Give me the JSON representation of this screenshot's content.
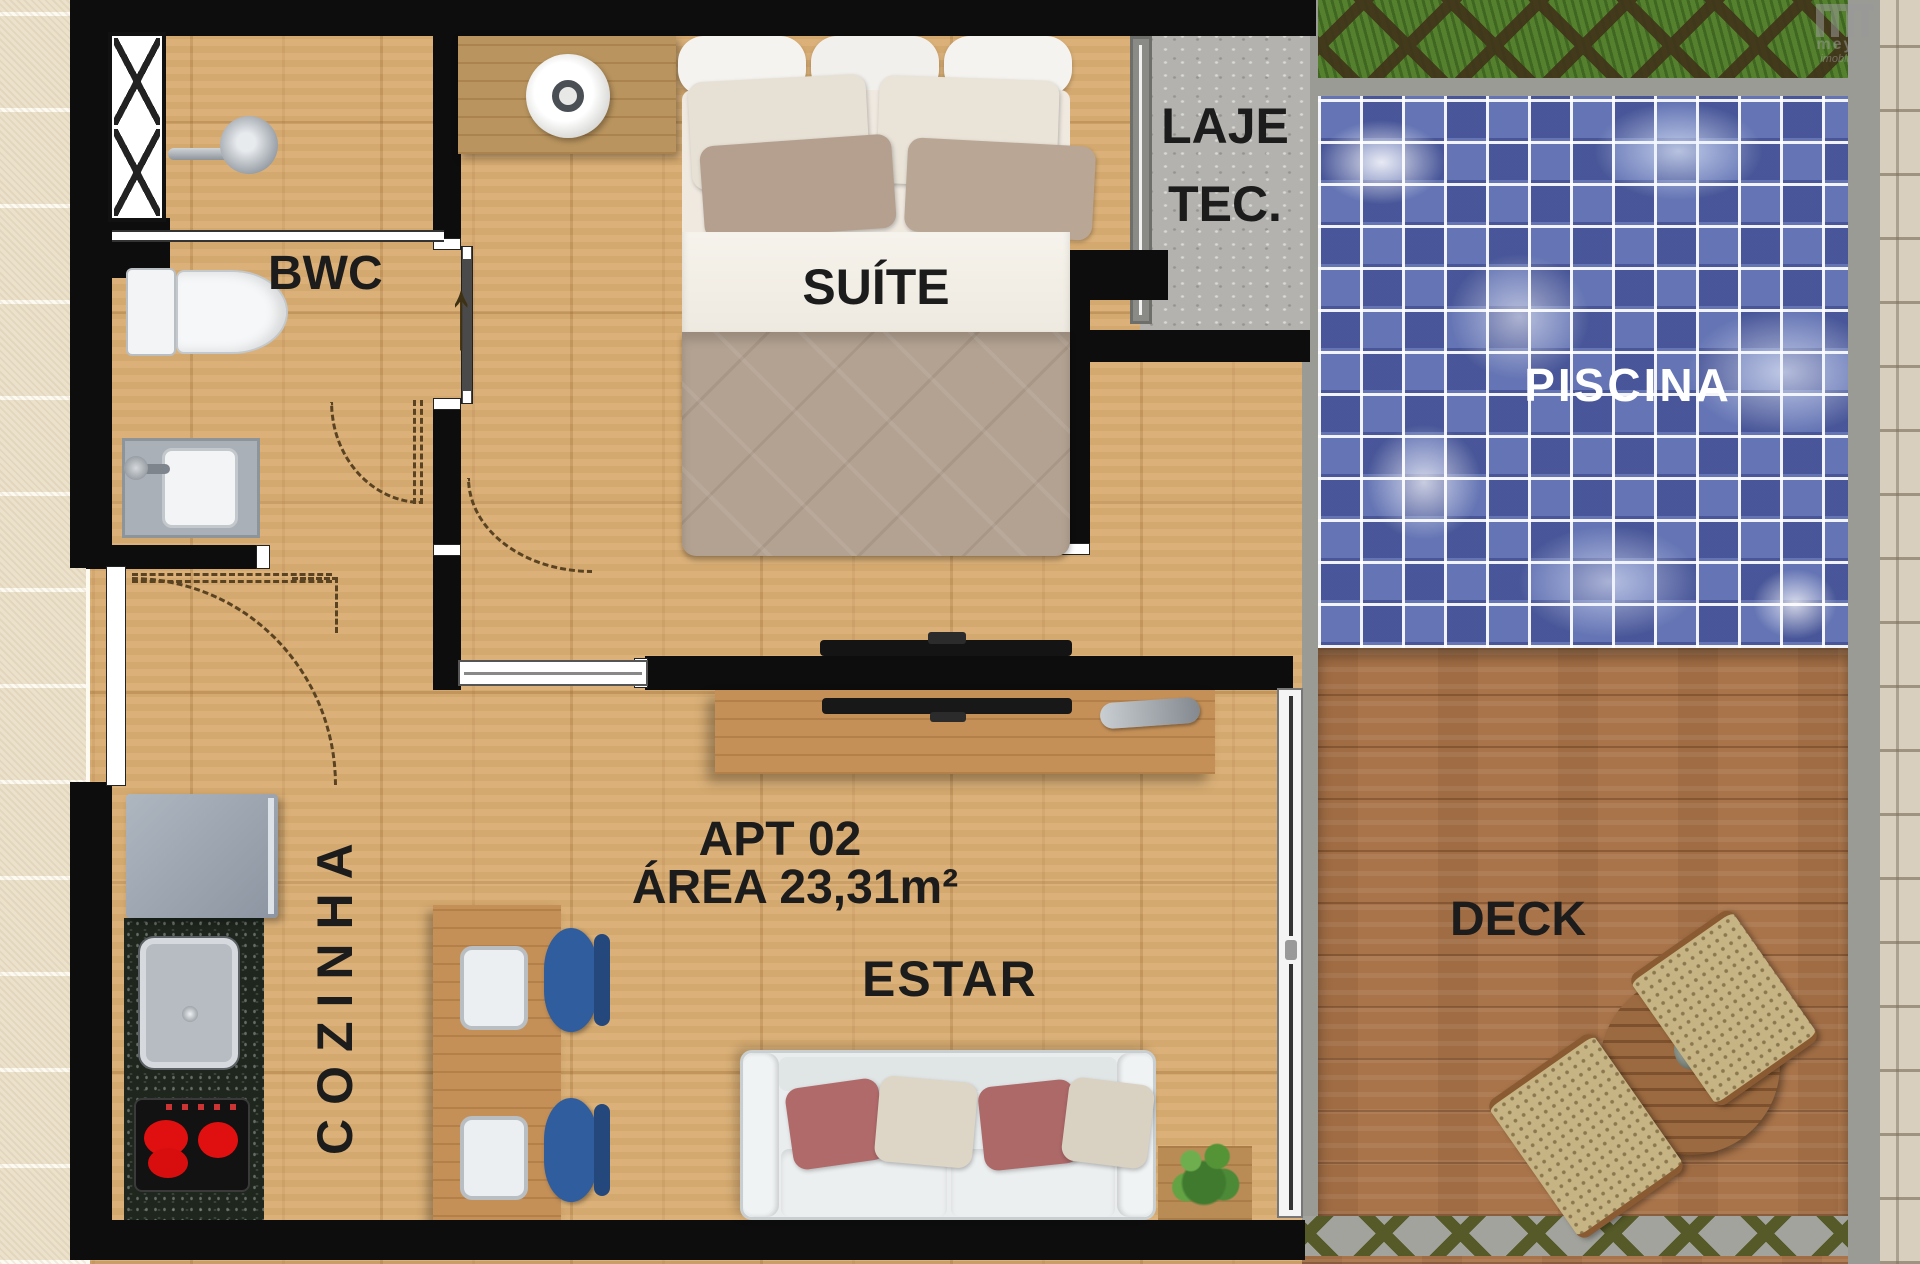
{
  "labels": {
    "bwc": "BWC",
    "suite": "SUÍTE",
    "laje_line1": "LAJE",
    "laje_line2": "TEC.",
    "piscina": "PISCINA",
    "cozinha": "COZINHA",
    "apt": "APT 02",
    "area": "ÁREA 23,31m²",
    "estar": "ESTAR",
    "deck": "DECK"
  },
  "watermark": {
    "brand": "meyer",
    "tagline": "imobiliária"
  },
  "icons": {
    "entry_arrow": "↑"
  },
  "colors": {
    "wall": "#0d0d0d",
    "pool_water": "#6474b4",
    "pool_label": "#ffffff",
    "label": "#1c1c1c",
    "deck_wood": "#a9744a",
    "floor_wood": "#d9ad72",
    "grass": "#55812e",
    "chair_blue": "#2f5d9e",
    "burner_red": "#e01010",
    "granite": "#1e261e"
  }
}
